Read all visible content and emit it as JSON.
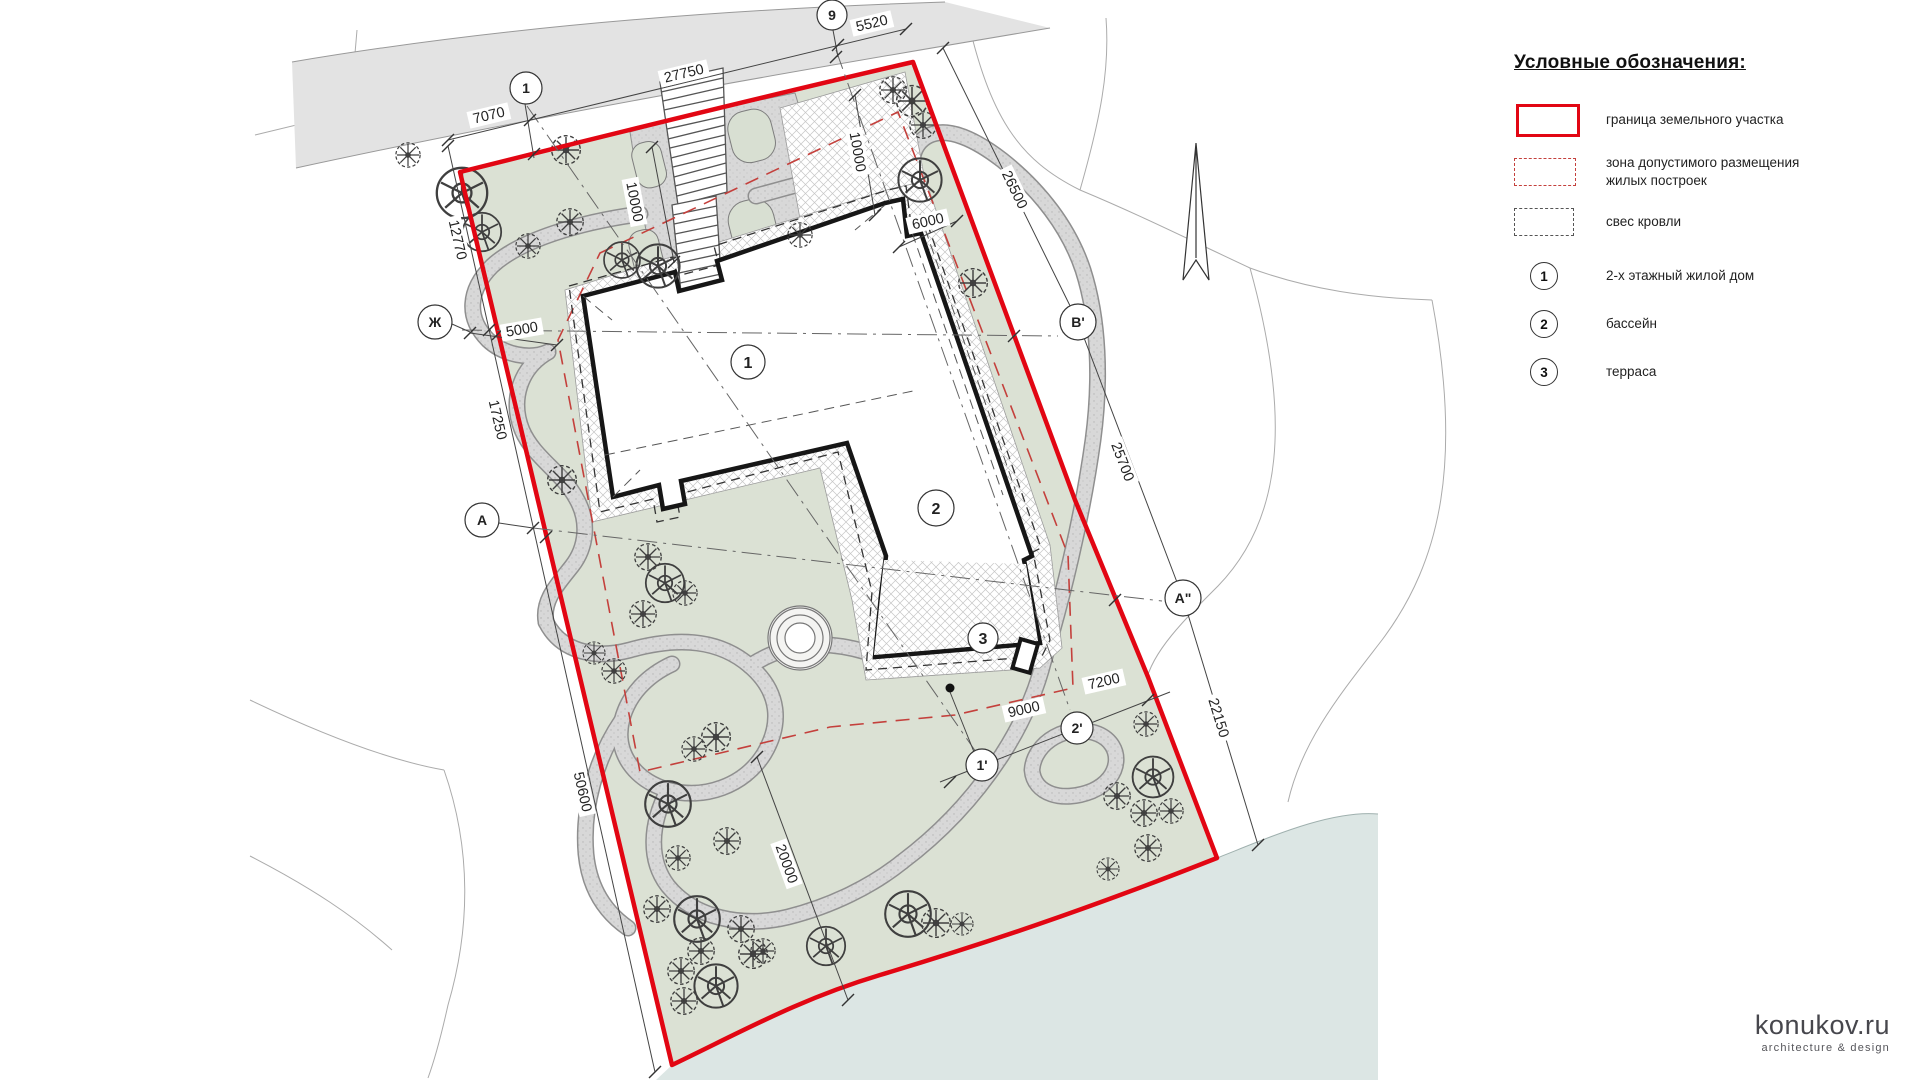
{
  "legend": {
    "title": "Условные обозначения:",
    "items": [
      {
        "symbol": "boundary-solid-red",
        "label": "граница земельного участка"
      },
      {
        "symbol": "zone-dashed-red",
        "label": "зона допустимого размещения жилых построек"
      },
      {
        "symbol": "roof-dashed-gray",
        "label": "свес кровли"
      },
      {
        "symbol": "circle-1",
        "num": "1",
        "label": "2-х этажный жилой дом"
      },
      {
        "symbol": "circle-2",
        "num": "2",
        "label": "бассейн"
      },
      {
        "symbol": "circle-3",
        "num": "3",
        "label": "терраса"
      }
    ],
    "colors": {
      "boundary": "#e20613",
      "zone": "#c4403c",
      "roof": "#555555"
    }
  },
  "plan": {
    "dimensions": {
      "d7070": "7070",
      "d27750": "27750",
      "d5520": "5520",
      "d12770": "12770",
      "d17250": "17250",
      "d50600": "50600",
      "d5000": "5000",
      "d10000a": "10000",
      "d10000b": "10000",
      "d6000": "6000",
      "d26500": "26500",
      "d25700": "25700",
      "d22150": "22150",
      "d20000": "20000",
      "d9000": "9000",
      "d7200": "7200"
    },
    "axes": {
      "a1": "1",
      "a9": "9",
      "zh": "Ж",
      "a": "А",
      "b1": "В'",
      "a2": "А\"",
      "p1": "1'",
      "p2": "2'"
    },
    "buildings": {
      "b1": "1",
      "b2": "2",
      "b3": "3"
    },
    "colors": {
      "boundary": "#e20613",
      "lawn": "#dbe1d4",
      "road": "#e3e3e3",
      "water": "#dce6e4",
      "gravel": "#d8d8d8"
    }
  },
  "logo": {
    "name": "konukov.ru",
    "tagline": "architecture & design"
  }
}
